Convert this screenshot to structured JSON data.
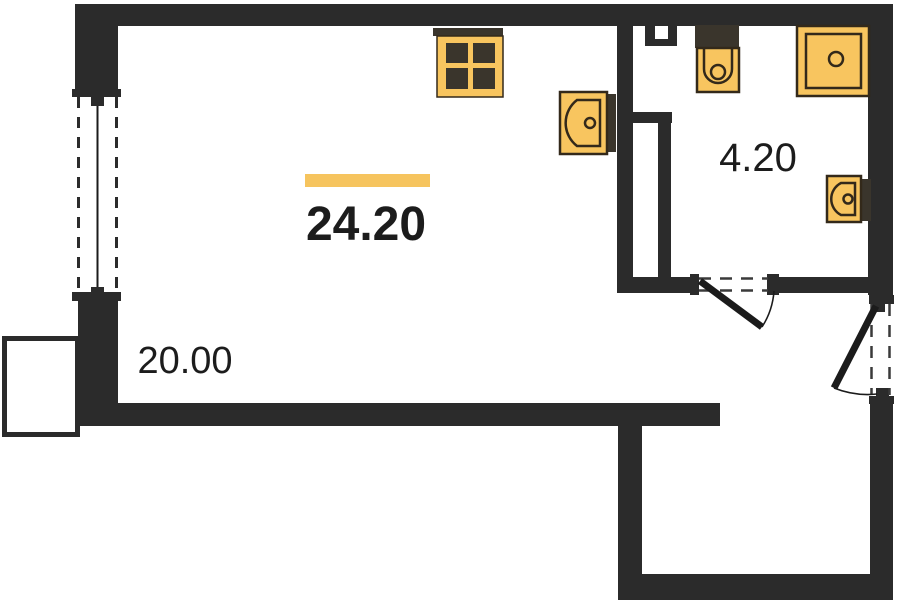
{
  "page": {
    "type": "apartment-floor-plan"
  },
  "labels": {
    "total_area": "24.20",
    "bathroom_area": "4.20",
    "main_room_area": "20.00"
  },
  "colors": {
    "wall": "#2b2b2b",
    "fixture_fill": "#f8c55f",
    "fixture_stroke": "#33291a",
    "fixture_dark": "#3a352c",
    "accent_bar": "#f6c45e",
    "label_text": "#1c1c1c",
    "background": "#ffffff"
  },
  "fixtures": [
    {
      "name": "stove",
      "icon": "stove-icon"
    },
    {
      "name": "kitchen-sink",
      "icon": "sink-icon"
    },
    {
      "name": "toilet",
      "icon": "toilet-icon"
    },
    {
      "name": "shower",
      "icon": "shower-icon"
    },
    {
      "name": "washbasin",
      "icon": "washbasin-icon"
    }
  ],
  "openings": [
    {
      "name": "window",
      "wall": "left"
    },
    {
      "name": "bathroom-door",
      "wall": "bathroom-partition"
    },
    {
      "name": "entrance-door",
      "wall": "right"
    },
    {
      "name": "balcony",
      "wall": "left"
    },
    {
      "name": "vent-shaft",
      "wall": "top"
    }
  ]
}
